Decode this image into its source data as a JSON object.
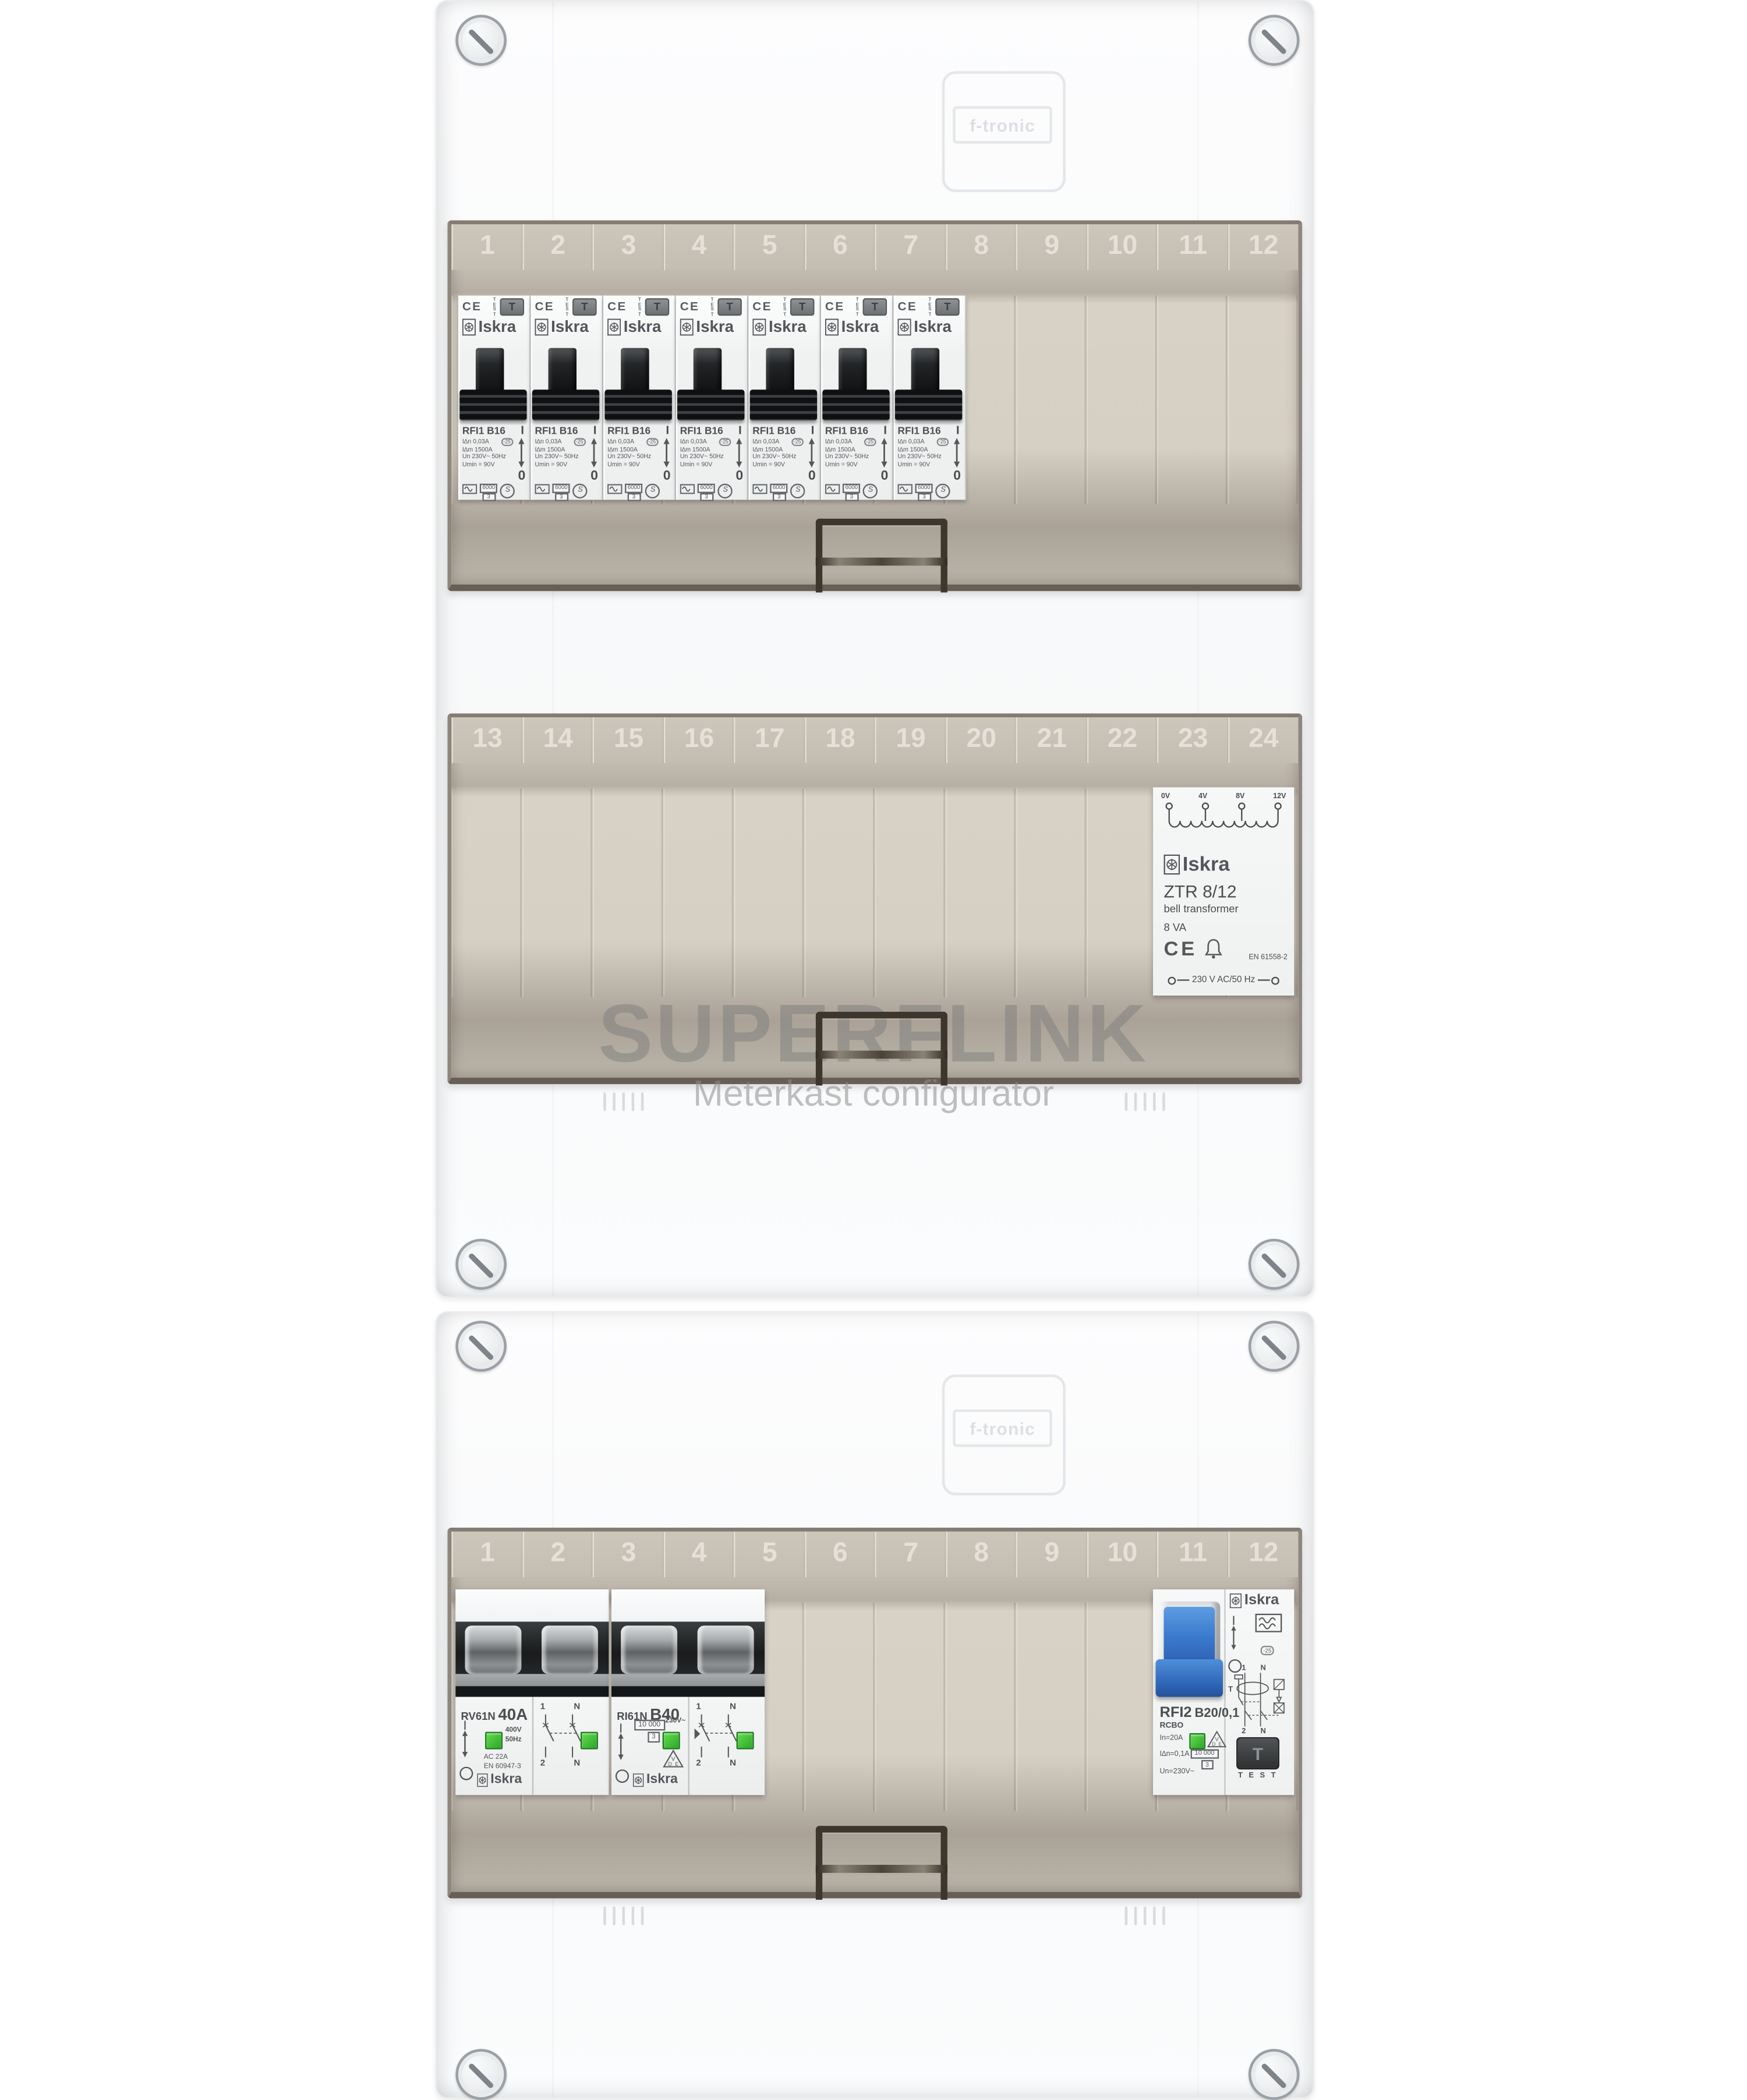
{
  "watermark": {
    "title": "SUPERFLINK",
    "subtitle": "Meterkast configurator"
  },
  "enclosure": {
    "brand_embossed": "f-tronic",
    "colors": {
      "plate_beige": "#d6d0c4",
      "frame_brown": "#8f867c",
      "green_indicator": "#35b531",
      "blue_toggle": "#3a78cc"
    }
  },
  "row1": {
    "slots": [
      "1",
      "2",
      "3",
      "4",
      "5",
      "6",
      "7",
      "8",
      "9",
      "10",
      "11",
      "12"
    ]
  },
  "row2": {
    "slots": [
      "13",
      "14",
      "15",
      "16",
      "17",
      "18",
      "19",
      "20",
      "21",
      "22",
      "23",
      "24"
    ]
  },
  "row3": {
    "slots": [
      "1",
      "2",
      "3",
      "4",
      "5",
      "6",
      "7",
      "8",
      "9",
      "10",
      "11",
      "12"
    ]
  },
  "rcd_breaker": {
    "count": 7,
    "ce": "CE",
    "test_vertical": "TEST",
    "test_button": "T",
    "brand": "Iskra",
    "model": "RFI1 B16",
    "specs": [
      "I∆n 0,03A",
      "I∆m 1500A",
      "Un 230V~ 50Hz",
      "Umin = 90V"
    ],
    "temp_badge": "-25",
    "breaking_capacity": "6000",
    "energy_class": "3",
    "s_mark": "S",
    "on": "I",
    "off": "0"
  },
  "transformer": {
    "taps": [
      "0V",
      "4V",
      "8V",
      "12V"
    ],
    "brand": "Iskra",
    "model": "ZTR 8/12",
    "description": "bell transformer",
    "power": "8 VA",
    "ce": "CE",
    "standard": "EN 61558-2",
    "supply": "230 V AC/50 Hz"
  },
  "main_switch": {
    "model": "RV61N",
    "rating": "40A",
    "voltage": "400V",
    "frequency": "50Hz",
    "utilization": "AC 22A",
    "standard": "EN 60947-3",
    "brand": "Iskra",
    "on": "|",
    "term_1": "1",
    "term_2": "2",
    "term_n": "N"
  },
  "mcb": {
    "model": "RI61N",
    "rating": "B40",
    "breaking_capacity": "10 000",
    "energy_class": "3",
    "voltage": "230V~",
    "brand": "Iskra",
    "on": "|",
    "term_1": "1",
    "term_2": "2",
    "term_n": "N"
  },
  "rcbo": {
    "brand": "Iskra",
    "model": "RFI2",
    "type_label": "RCBO",
    "rating": "B20/0,1",
    "rated_current": "In=20A",
    "residual_current": "I∆n=0,1A",
    "voltage": "Un=230V~",
    "breaking_capacity": "10 000",
    "energy_class": "3",
    "temp_badge": "-25",
    "test_button": "T",
    "test_label": "T E S T",
    "on": "|",
    "term_1": "1",
    "term_2": "2",
    "term_n": "N",
    "t_mark": "T"
  }
}
